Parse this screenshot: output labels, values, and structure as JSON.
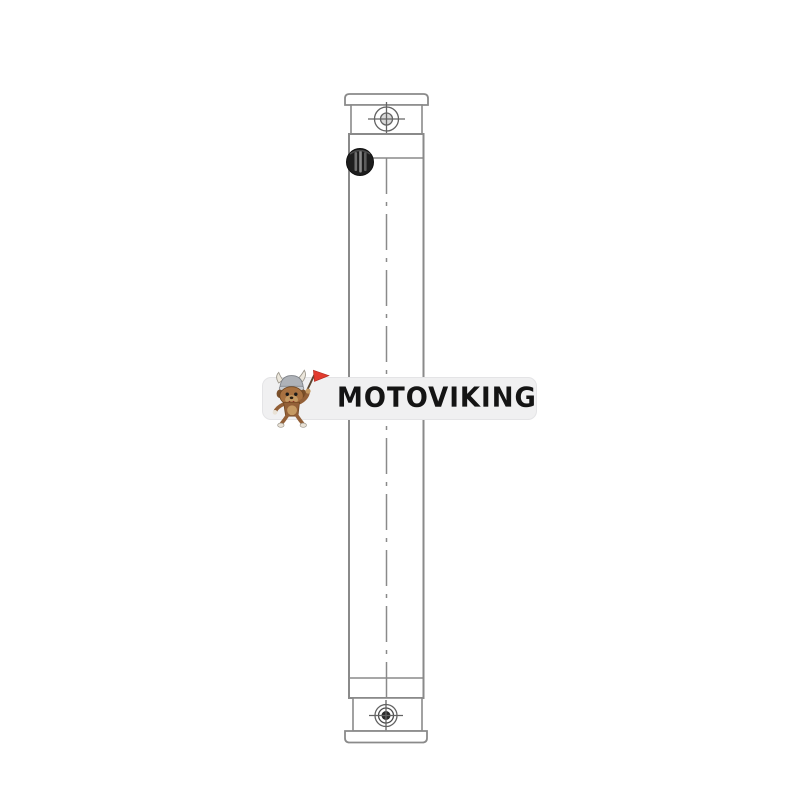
{
  "page": {
    "background": "#ffffff",
    "description": "Product listing image: technical line drawing of a tall narrow vertical radiator / hydraulic oil cooler with top and bottom mounting brackets, bolt holes, black filler cap and dash-dot centerline, overlaid with a MOTOVIKING watermark band"
  },
  "watermark": {
    "brand": "MOTOVIKING",
    "mascot_icon": "viking-dog-with-red-flag-icon",
    "band_color": "#f0f0f1",
    "text_color": "#141414",
    "flag_color": "#e23b2e"
  },
  "drawing": {
    "line_color": "#8a8a8a",
    "bolt_line_color": "#636363",
    "filler_cap_color": "#1d1d1d",
    "parts": [
      "top-mounting-flange",
      "top-mounting-bracket",
      "top-bolt-hole",
      "filler-cap",
      "radiator-core",
      "centerline",
      "bottom-tank",
      "bottom-mounting-bracket",
      "bottom-bolt-hole",
      "bottom-mounting-flange"
    ]
  }
}
